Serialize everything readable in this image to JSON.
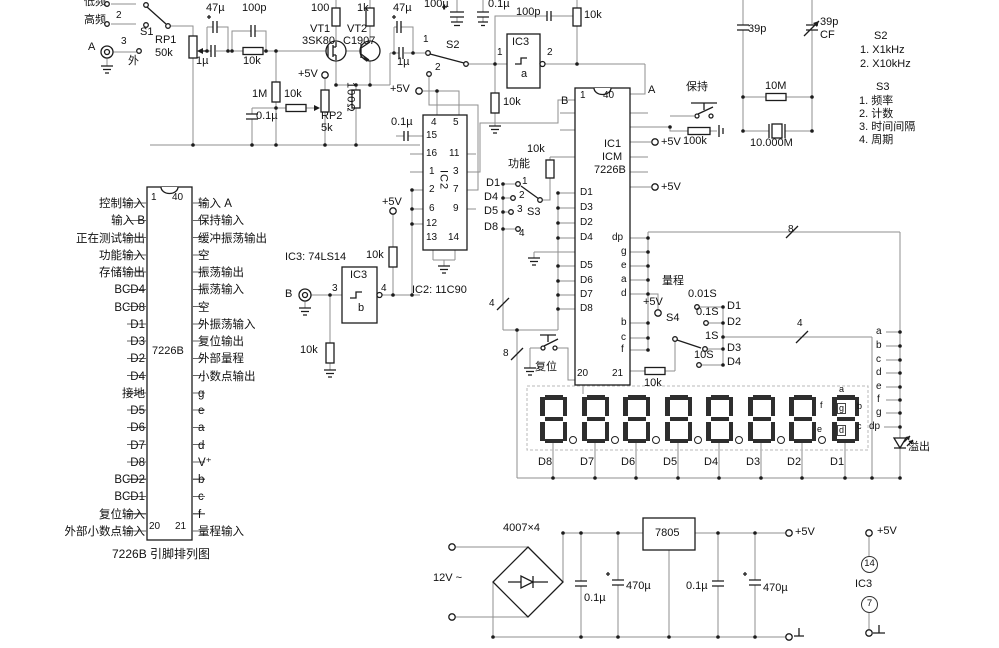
{
  "schematic": {
    "colors": {
      "wire": "#8f8f8f",
      "component": "#1c1c1c",
      "text": "#111111",
      "segment": "#2e2e2e",
      "background": "#ffffff"
    },
    "pinout": {
      "chip": "7226B",
      "caption": "7226B 引脚排列图",
      "left": [
        "控制输入",
        "输入 B",
        "正在测试输出",
        "功能输入",
        "存储输出",
        "BCD4",
        "BCD8",
        "D1",
        "D3",
        "D2",
        "D4",
        "接地",
        "D5",
        "D6",
        "D7",
        "D8",
        "BCD2",
        "BCD1",
        "复位输入",
        "外部小数点输入"
      ],
      "right": [
        "输入 A",
        "保持输入",
        "缓冲振荡输出",
        "空",
        "振荡输出",
        "振荡输入",
        "空",
        "外振荡输入",
        "复位输出",
        "外部量程",
        "小数点输出",
        "g",
        "e",
        "a",
        "d",
        "V⁺",
        "b",
        "c",
        "f",
        "量程输入"
      ]
    },
    "display": {
      "digits": [
        "D8",
        "D7",
        "D6",
        "D5",
        "D4",
        "D3",
        "D2",
        "D1"
      ],
      "overflow": "溢出",
      "segment_bus": [
        "a",
        "b",
        "c",
        "d",
        "e",
        "f",
        "g",
        "dp"
      ]
    },
    "labels": [
      {
        "n": "s1-pos1-label",
        "t": "低频",
        "x": 84,
        "y": -4
      },
      {
        "n": "s1-pos2-label",
        "t": "高频",
        "x": 84,
        "y": 14
      },
      {
        "n": "s1-pos2-num",
        "t": "2",
        "x": 116,
        "y": 10,
        "c": "sm"
      },
      {
        "n": "s1-pos3-num",
        "t": "3",
        "x": 121,
        "y": 36,
        "c": "sm"
      },
      {
        "n": "input-a-label",
        "t": "A",
        "x": 88,
        "y": 41
      },
      {
        "n": "s1-pos3-label",
        "t": "外",
        "x": 128,
        "y": 55
      },
      {
        "n": "s1-label",
        "t": "S1",
        "x": 140,
        "y": 26
      },
      {
        "n": "rp1-label",
        "t": "RP1",
        "x": 155,
        "y": 34
      },
      {
        "n": "rp1-value",
        "t": "50k",
        "x": 155,
        "y": 47
      },
      {
        "n": "cap-47u-1",
        "t": "47µ",
        "x": 206,
        "y": 2
      },
      {
        "n": "cap-100p-1",
        "t": "100p",
        "x": 242,
        "y": 2
      },
      {
        "n": "cap-1u-1",
        "t": "1µ",
        "x": 196,
        "y": 55
      },
      {
        "n": "res-10k-1",
        "t": "10k",
        "x": 243,
        "y": 55
      },
      {
        "n": "res-100",
        "t": "100",
        "x": 311,
        "y": 2
      },
      {
        "n": "res-1k",
        "t": "1k",
        "x": 357,
        "y": 2
      },
      {
        "n": "vt1-label",
        "t": "VT1",
        "x": 310,
        "y": 23
      },
      {
        "n": "vt1-type",
        "t": "3SK80",
        "x": 302,
        "y": 35
      },
      {
        "n": "vt2-label",
        "t": "VT2",
        "x": 347,
        "y": 23
      },
      {
        "n": "vt2-type",
        "t": "C1907",
        "x": 343,
        "y": 35
      },
      {
        "n": "res-1m",
        "t": "1M",
        "x": 252,
        "y": 88
      },
      {
        "n": "res-10k-2",
        "t": "10k",
        "x": 284,
        "y": 88
      },
      {
        "n": "p5v-rp2",
        "t": "+5V",
        "x": 298,
        "y": 68
      },
      {
        "n": "cap-01u-1",
        "t": "0.1µ",
        "x": 256,
        "y": 110
      },
      {
        "n": "rp2-label",
        "t": "RP2",
        "x": 321,
        "y": 110
      },
      {
        "n": "rp2-value",
        "t": "5k",
        "x": 321,
        "y": 122
      },
      {
        "n": "res-100ohm",
        "t": "100Ω",
        "x": 344,
        "y": 82,
        "c": "v"
      },
      {
        "n": "cap-47u-2",
        "t": "47µ",
        "x": 393,
        "y": 2
      },
      {
        "n": "cap-1u-2",
        "t": "1µ",
        "x": 397,
        "y": 56
      },
      {
        "n": "cap-100u",
        "t": "100µ",
        "x": 424,
        "y": -2
      },
      {
        "n": "cap-01u-2",
        "t": "0.1µ",
        "x": 488,
        "y": -2
      },
      {
        "n": "s2-pos1-num",
        "t": "1",
        "x": 423,
        "y": 34,
        "c": "sm"
      },
      {
        "n": "s2-pos2-num",
        "t": "2",
        "x": 435,
        "y": 62,
        "c": "sm"
      },
      {
        "n": "s2-label",
        "t": "S2",
        "x": 446,
        "y": 39
      },
      {
        "n": "ic3a-pin1",
        "t": "1",
        "x": 497,
        "y": 47,
        "c": "sm"
      },
      {
        "n": "ic3a-pin2",
        "t": "2",
        "x": 547,
        "y": 47,
        "c": "sm"
      },
      {
        "n": "ic3a-label",
        "t": "IC3",
        "x": 512,
        "y": 36
      },
      {
        "n": "ic3a-sub",
        "t": "a",
        "x": 521,
        "y": 68
      },
      {
        "n": "cap-100p-2",
        "t": "100p",
        "x": 516,
        "y": 6
      },
      {
        "n": "res-10k-3",
        "t": "10k",
        "x": 584,
        "y": 9
      },
      {
        "n": "res-10k-4",
        "t": "10k",
        "x": 503,
        "y": 96
      },
      {
        "n": "p5v-ic2",
        "t": "+5V",
        "x": 390,
        "y": 83
      },
      {
        "n": "cap-01u-3",
        "t": "0.1µ",
        "x": 391,
        "y": 116
      },
      {
        "n": "ic2-pin4",
        "t": "4",
        "x": 431,
        "y": 117,
        "c": "sm"
      },
      {
        "n": "ic2-pin5",
        "t": "5",
        "x": 453,
        "y": 117,
        "c": "sm"
      },
      {
        "n": "ic2-pin15",
        "t": "15",
        "x": 426,
        "y": 130,
        "c": "sm"
      },
      {
        "n": "ic2-pin16",
        "t": "16",
        "x": 426,
        "y": 148,
        "c": "sm"
      },
      {
        "n": "ic2-pin11",
        "t": "11",
        "x": 449,
        "y": 148,
        "c": "sm"
      },
      {
        "n": "ic2-pin1",
        "t": "1",
        "x": 429,
        "y": 166,
        "c": "sm"
      },
      {
        "n": "ic2-pin3",
        "t": "3",
        "x": 453,
        "y": 166,
        "c": "sm"
      },
      {
        "n": "ic2-pin2",
        "t": "2",
        "x": 429,
        "y": 184,
        "c": "sm"
      },
      {
        "n": "ic2-pin7",
        "t": "7",
        "x": 453,
        "y": 184,
        "c": "sm"
      },
      {
        "n": "ic2-pin6",
        "t": "6",
        "x": 429,
        "y": 203,
        "c": "sm"
      },
      {
        "n": "ic2-pin9",
        "t": "9",
        "x": 453,
        "y": 203,
        "c": "sm"
      },
      {
        "n": "ic2-pin12",
        "t": "12",
        "x": 426,
        "y": 218,
        "c": "sm"
      },
      {
        "n": "ic2-pin13",
        "t": "13",
        "x": 426,
        "y": 232,
        "c": "sm"
      },
      {
        "n": "ic2-pin14",
        "t": "14",
        "x": 448,
        "y": 232,
        "c": "sm"
      },
      {
        "n": "ic2-name",
        "t": "IC2",
        "x": 437,
        "y": 170,
        "c": "v"
      },
      {
        "n": "ic2-type",
        "t": "IC2: 11C90",
        "x": 412,
        "y": 284
      },
      {
        "n": "p5v-ic3b",
        "t": "+5V",
        "x": 382,
        "y": 196
      },
      {
        "n": "res-10k-5",
        "t": "10k",
        "x": 366,
        "y": 249
      },
      {
        "n": "ic3-type",
        "t": "IC3: 74LS14",
        "x": 285,
        "y": 251
      },
      {
        "n": "ic3b-pin3",
        "t": "3",
        "x": 332,
        "y": 283,
        "c": "sm"
      },
      {
        "n": "ic3b-pin4",
        "t": "4",
        "x": 381,
        "y": 283,
        "c": "sm"
      },
      {
        "n": "ic3b-label",
        "t": "IC3",
        "x": 350,
        "y": 269
      },
      {
        "n": "ic3b-sub",
        "t": "b",
        "x": 358,
        "y": 302
      },
      {
        "n": "input-b-label",
        "t": "B",
        "x": 285,
        "y": 288
      },
      {
        "n": "res-10k-6",
        "t": "10k",
        "x": 300,
        "y": 344
      },
      {
        "n": "ic1-pin1",
        "t": "1",
        "x": 580,
        "y": 90,
        "c": "sm"
      },
      {
        "n": "ic1-pin40",
        "t": "40",
        "x": 603,
        "y": 90,
        "c": "sm"
      },
      {
        "n": "ic1-a-label",
        "t": "A",
        "x": 648,
        "y": 84
      },
      {
        "n": "ic1-b-label",
        "t": "B",
        "x": 561,
        "y": 95
      },
      {
        "n": "ic1-name",
        "t": "IC1",
        "x": 604,
        "y": 138
      },
      {
        "n": "ic1-name2",
        "t": "ICM",
        "x": 602,
        "y": 151
      },
      {
        "n": "ic1-name3",
        "t": "7226B",
        "x": 594,
        "y": 164
      },
      {
        "n": "ic1-d1",
        "t": "D1",
        "x": 580,
        "y": 187,
        "c": "sm"
      },
      {
        "n": "ic1-d3",
        "t": "D3",
        "x": 580,
        "y": 202,
        "c": "sm"
      },
      {
        "n": "ic1-d2",
        "t": "D2",
        "x": 580,
        "y": 217,
        "c": "sm"
      },
      {
        "n": "ic1-d4",
        "t": "D4",
        "x": 580,
        "y": 232,
        "c": "sm"
      },
      {
        "n": "ic1-d5",
        "t": "D5",
        "x": 580,
        "y": 260,
        "c": "sm"
      },
      {
        "n": "ic1-d6",
        "t": "D6",
        "x": 580,
        "y": 275,
        "c": "sm"
      },
      {
        "n": "ic1-d7",
        "t": "D7",
        "x": 580,
        "y": 289,
        "c": "sm"
      },
      {
        "n": "ic1-d8",
        "t": "D8",
        "x": 580,
        "y": 303,
        "c": "sm"
      },
      {
        "n": "ic1-dp",
        "t": "dp",
        "x": 612,
        "y": 232,
        "c": "sm"
      },
      {
        "n": "ic1-g",
        "t": "g",
        "x": 621,
        "y": 246,
        "c": "sm"
      },
      {
        "n": "ic1-e",
        "t": "e",
        "x": 621,
        "y": 260,
        "c": "sm"
      },
      {
        "n": "ic1-sa",
        "t": "a",
        "x": 621,
        "y": 274,
        "c": "sm"
      },
      {
        "n": "ic1-sd",
        "t": "d",
        "x": 621,
        "y": 288,
        "c": "sm"
      },
      {
        "n": "ic1-sb",
        "t": "b",
        "x": 621,
        "y": 317,
        "c": "sm"
      },
      {
        "n": "ic1-sc",
        "t": "c",
        "x": 621,
        "y": 332,
        "c": "sm"
      },
      {
        "n": "ic1-sf",
        "t": "f",
        "x": 621,
        "y": 344,
        "c": "sm"
      },
      {
        "n": "ic1-pin20",
        "t": "20",
        "x": 577,
        "y": 368,
        "c": "sm"
      },
      {
        "n": "ic1-pin21",
        "t": "21",
        "x": 612,
        "y": 368,
        "c": "sm"
      },
      {
        "n": "res-10k-7",
        "t": "10k",
        "x": 527,
        "y": 143
      },
      {
        "n": "func-label",
        "t": "功能",
        "x": 508,
        "y": 158
      },
      {
        "n": "s3-d1",
        "t": "D1",
        "x": 486,
        "y": 177
      },
      {
        "n": "s3-d4",
        "t": "D4",
        "x": 484,
        "y": 191
      },
      {
        "n": "s3-d5",
        "t": "D5",
        "x": 484,
        "y": 205
      },
      {
        "n": "s3-d8",
        "t": "D8",
        "x": 484,
        "y": 221
      },
      {
        "n": "s3-num1",
        "t": "1",
        "x": 522,
        "y": 176,
        "c": "sm"
      },
      {
        "n": "s3-num2",
        "t": "2",
        "x": 519,
        "y": 190,
        "c": "sm"
      },
      {
        "n": "s3-num3",
        "t": "3",
        "x": 517,
        "y": 204,
        "c": "sm"
      },
      {
        "n": "s3-num4",
        "t": "4",
        "x": 519,
        "y": 228,
        "c": "sm"
      },
      {
        "n": "s3-label",
        "t": "S3",
        "x": 527,
        "y": 206
      },
      {
        "n": "bus4-left",
        "t": "4",
        "x": 489,
        "y": 298,
        "c": "sm"
      },
      {
        "n": "bus8-left",
        "t": "8",
        "x": 503,
        "y": 348,
        "c": "sm"
      },
      {
        "n": "reset-label",
        "t": "复位",
        "x": 535,
        "y": 361
      },
      {
        "n": "res-10k-8",
        "t": "10k",
        "x": 644,
        "y": 377
      },
      {
        "n": "hold-label",
        "t": "保持",
        "x": 686,
        "y": 81
      },
      {
        "n": "res-100k",
        "t": "100k",
        "x": 683,
        "y": 135
      },
      {
        "n": "p5v-ic1a",
        "t": "+5V",
        "x": 661,
        "y": 136
      },
      {
        "n": "p5v-ic1b",
        "t": "+5V",
        "x": 661,
        "y": 181
      },
      {
        "n": "res-10m",
        "t": "10M",
        "x": 765,
        "y": 80
      },
      {
        "n": "xtal-value",
        "t": "10.000M",
        "x": 750,
        "y": 137
      },
      {
        "n": "cap-39p-1",
        "t": "39p",
        "x": 748,
        "y": 23
      },
      {
        "n": "cap-39p-2",
        "t": "39p",
        "x": 820,
        "y": 16
      },
      {
        "n": "cap-cf",
        "t": "CF",
        "x": 820,
        "y": 29
      },
      {
        "n": "legend-s2-title",
        "t": "S2",
        "x": 874,
        "y": 30
      },
      {
        "n": "legend-s2-1",
        "t": "1. X1kHz",
        "x": 860,
        "y": 44
      },
      {
        "n": "legend-s2-2",
        "t": "2. X10kHz",
        "x": 860,
        "y": 58
      },
      {
        "n": "legend-s3-title",
        "t": "S3",
        "x": 876,
        "y": 81
      },
      {
        "n": "legend-s3-1",
        "t": "1. 频率",
        "x": 859,
        "y": 95
      },
      {
        "n": "legend-s3-2",
        "t": "2. 计数",
        "x": 859,
        "y": 108
      },
      {
        "n": "legend-s3-3",
        "t": "3. 时间间隔",
        "x": 859,
        "y": 121
      },
      {
        "n": "legend-s3-4",
        "t": "4. 周期",
        "x": 859,
        "y": 134
      },
      {
        "n": "range-label",
        "t": "量程",
        "x": 662,
        "y": 275
      },
      {
        "n": "s4-time1",
        "t": "0.01S",
        "x": 688,
        "y": 288
      },
      {
        "n": "s4-d1",
        "t": "D1",
        "x": 727,
        "y": 300
      },
      {
        "n": "s4-time2",
        "t": "0.1S",
        "x": 696,
        "y": 306
      },
      {
        "n": "s4-d2",
        "t": "D2",
        "x": 727,
        "y": 316
      },
      {
        "n": "s4-label",
        "t": "S4",
        "x": 666,
        "y": 312
      },
      {
        "n": "s4-time3",
        "t": "1S",
        "x": 705,
        "y": 330
      },
      {
        "n": "s4-d3",
        "t": "D3",
        "x": 727,
        "y": 342
      },
      {
        "n": "s4-time4",
        "t": "10S",
        "x": 694,
        "y": 349
      },
      {
        "n": "s4-d4",
        "t": "D4",
        "x": 727,
        "y": 356
      },
      {
        "n": "bus4-right",
        "t": "4",
        "x": 797,
        "y": 318,
        "c": "sm"
      },
      {
        "n": "bus8-right",
        "t": "8",
        "x": 788,
        "y": 224,
        "c": "sm"
      },
      {
        "n": "p5v-seg-d",
        "t": "+5V",
        "x": 643,
        "y": 296
      },
      {
        "n": "seg-a",
        "t": "a",
        "x": 876,
        "y": 326,
        "c": "sm"
      },
      {
        "n": "seg-b",
        "t": "b",
        "x": 876,
        "y": 340,
        "c": "sm"
      },
      {
        "n": "seg-c",
        "t": "c",
        "x": 876,
        "y": 354,
        "c": "sm"
      },
      {
        "n": "seg-d",
        "t": "d",
        "x": 876,
        "y": 367,
        "c": "sm"
      },
      {
        "n": "seg-e",
        "t": "e",
        "x": 876,
        "y": 381,
        "c": "sm"
      },
      {
        "n": "seg-f",
        "t": "f",
        "x": 877,
        "y": 394,
        "c": "sm"
      },
      {
        "n": "seg-g",
        "t": "g",
        "x": 876,
        "y": 407,
        "c": "sm"
      },
      {
        "n": "seg-dp",
        "t": "dp",
        "x": 869,
        "y": 421,
        "c": "sm"
      },
      {
        "n": "overflow-label",
        "t": "溢出",
        "x": 908,
        "y": 441
      },
      {
        "n": "d1-seg-a",
        "t": "a",
        "x": 839,
        "y": 384,
        "c": "t"
      },
      {
        "n": "d1-seg-f",
        "t": "f",
        "x": 820,
        "y": 400,
        "c": "t"
      },
      {
        "n": "d1-seg-g",
        "t": "g",
        "x": 837,
        "y": 403,
        "c": "tb"
      },
      {
        "n": "d1-seg-b",
        "t": "b",
        "x": 857,
        "y": 401,
        "c": "t"
      },
      {
        "n": "d1-seg-e",
        "t": "e",
        "x": 817,
        "y": 424,
        "c": "t"
      },
      {
        "n": "d1-seg-d",
        "t": "d",
        "x": 837,
        "y": 425,
        "c": "tb"
      },
      {
        "n": "d1-seg-c",
        "t": "c",
        "x": 857,
        "y": 421,
        "c": "t"
      },
      {
        "n": "psu-bridge",
        "t": "4007×4",
        "x": 503,
        "y": 522
      },
      {
        "n": "psu-input",
        "t": "12V ~",
        "x": 433,
        "y": 572
      },
      {
        "n": "psu-cap1",
        "t": "0.1µ",
        "x": 584,
        "y": 592
      },
      {
        "n": "psu-cap2",
        "t": "470µ",
        "x": 626,
        "y": 580
      },
      {
        "n": "psu-reg",
        "t": "7805",
        "x": 655,
        "y": 527
      },
      {
        "n": "psu-cap3",
        "t": "0.1µ",
        "x": 686,
        "y": 580
      },
      {
        "n": "psu-cap4",
        "t": "470µ",
        "x": 763,
        "y": 582
      },
      {
        "n": "psu-5v",
        "t": "+5V",
        "x": 795,
        "y": 526
      },
      {
        "n": "ic3-power-5v",
        "t": "+5V",
        "x": 877,
        "y": 525
      },
      {
        "n": "ic3-power-pin14",
        "t": "14",
        "x": 861,
        "y": 556,
        "c": "circ"
      },
      {
        "n": "ic3-power-label",
        "t": "IC3",
        "x": 855,
        "y": 578
      },
      {
        "n": "ic3-power-pin7",
        "t": "7",
        "x": 861,
        "y": 596,
        "c": "circ"
      },
      {
        "n": "pinout-pin1",
        "t": "1",
        "x": 151,
        "y": 192,
        "c": "sm"
      },
      {
        "n": "pinout-pin40",
        "t": "40",
        "x": 172,
        "y": 192,
        "c": "sm"
      },
      {
        "n": "pinout-pin20",
        "t": "20",
        "x": 149,
        "y": 521,
        "c": "sm"
      },
      {
        "n": "pinout-pin21",
        "t": "21",
        "x": 175,
        "y": 521,
        "c": "sm"
      },
      {
        "n": "pinout-chip",
        "t": "7226B",
        "x": 152,
        "y": 345
      },
      {
        "n": "pinout-caption",
        "t": "7226B 引脚排列图",
        "x": 112,
        "y": 548,
        "c": "cap"
      }
    ]
  }
}
